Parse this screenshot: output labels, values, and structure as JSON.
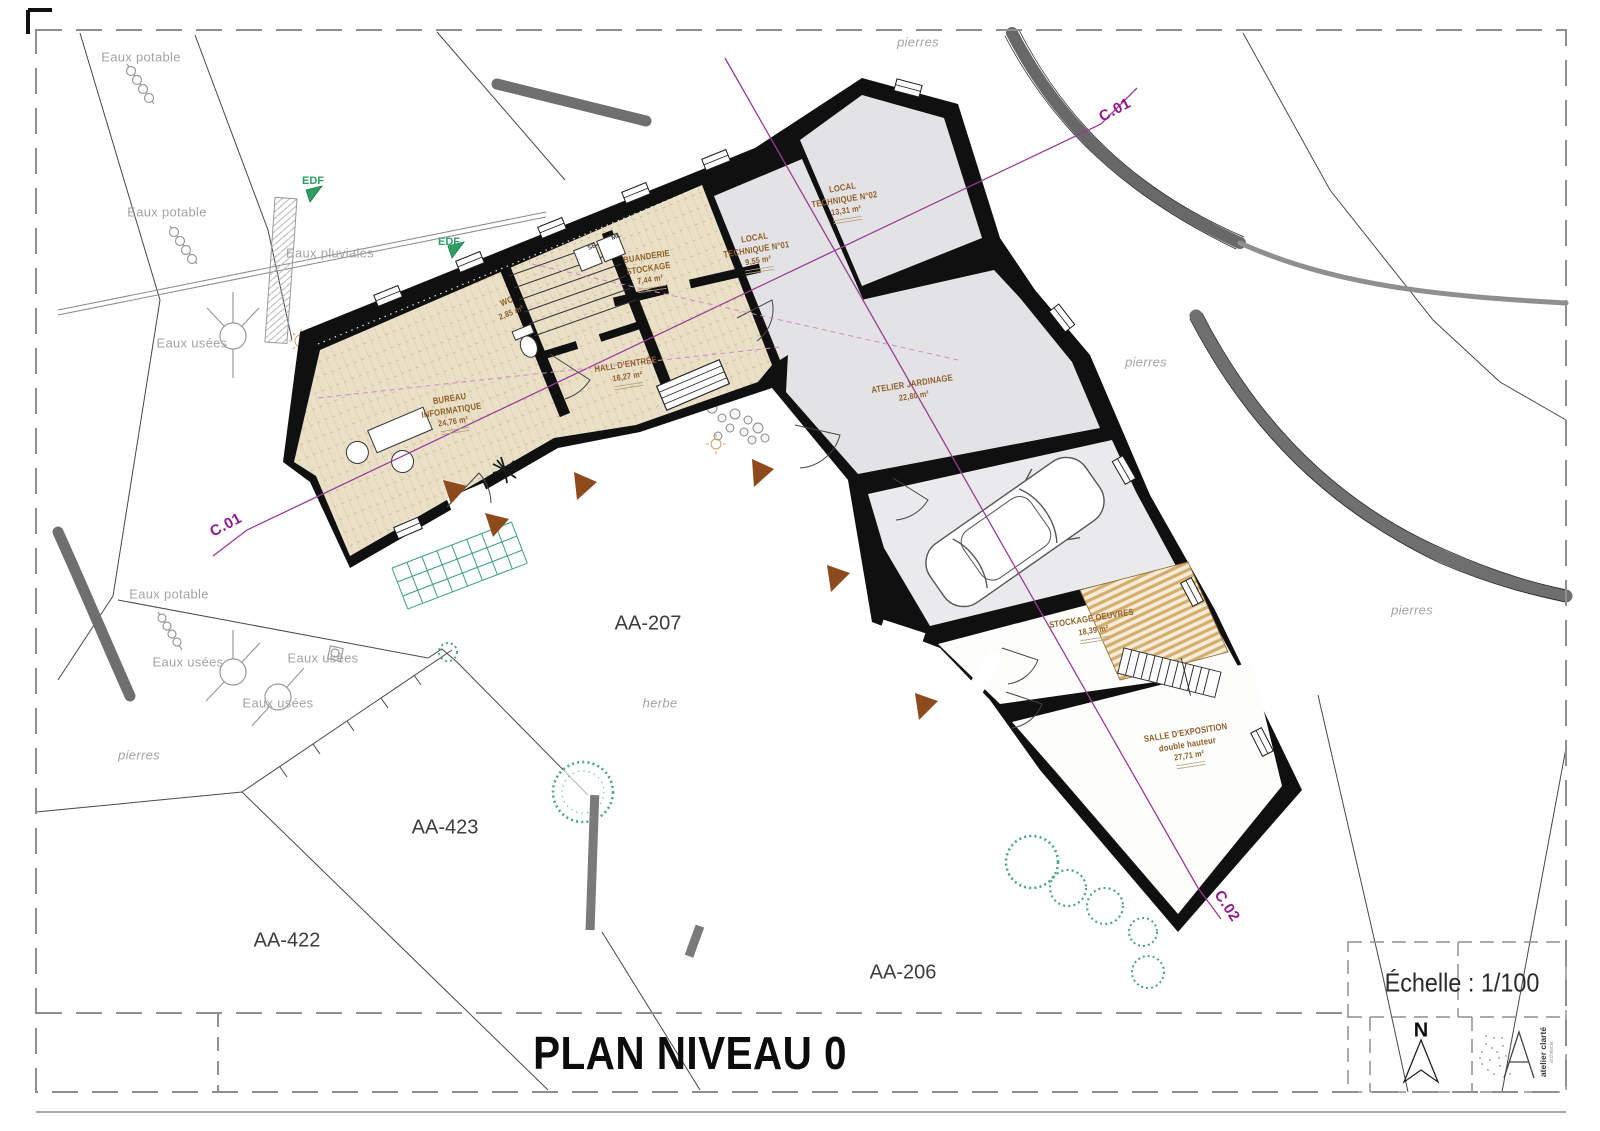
{
  "sheet": {
    "title": "PLAN NIVEAU 0",
    "scale_label": "Échelle : 1/100",
    "north_label": "N",
    "logo_name": "atelier clarté",
    "logo_subtitle": "architecte"
  },
  "sections": {
    "c01": "C.01",
    "c02": "C.02"
  },
  "parcels": {
    "aa207": "AA-207",
    "aa423": "AA-423",
    "aa422": "AA-422",
    "aa206": "AA-206"
  },
  "site": {
    "eaux_potable": "Eaux potable",
    "eaux_usees": "Eaux usées",
    "eaux_pluviales": "Eaux pluviales",
    "pierres": "pierres",
    "herbe": "herbe",
    "edf": "EDF"
  },
  "equipment": {
    "se": "SE",
    "ml": "ML"
  },
  "rooms": [
    {
      "id": "bureau",
      "line1": "BUREAU",
      "line2": "INFORMATIQUE",
      "area": "24,76 m²"
    },
    {
      "id": "wc",
      "line1": "WC",
      "line2": "",
      "area": "2,85 m²"
    },
    {
      "id": "hall",
      "line1": "HALL D'ENTRÉE",
      "line2": "",
      "area": "16,27 m²"
    },
    {
      "id": "buanderie",
      "line1": "BUANDERIE",
      "line2": "STOCKAGE",
      "area": "7,44 m²"
    },
    {
      "id": "local-technique-01",
      "line1": "LOCAL",
      "line2": "TECHNIQUE N°01",
      "area": "9,55 m²"
    },
    {
      "id": "local-technique-02",
      "line1": "LOCAL",
      "line2": "TECHNIQUE N°02",
      "area": "13,31 m²"
    },
    {
      "id": "atelier-jardinage",
      "line1": "ATELIER JARDINAGE",
      "line2": "",
      "area": "22,80 m²"
    },
    {
      "id": "stockage-oeuvres",
      "line1": "STOCKAGE OEUVRES",
      "line2": "",
      "area": "18,39 m²"
    },
    {
      "id": "salle-exposition",
      "line1": "SALLE D'EXPOSITION",
      "line2": "double hauteur",
      "area": "27,71 m²"
    }
  ],
  "colors": {
    "wall": "#101010",
    "floor_beige": "#eae0c8",
    "floor_gray": "#e3e3e5",
    "wood": "#d4ad6d",
    "section_purple": "#993b99",
    "label_brown": "#8f5e2a",
    "site_gray": "#a3a3a3",
    "green": "#3a9f7e",
    "road_gray": "#6f6f6f"
  }
}
